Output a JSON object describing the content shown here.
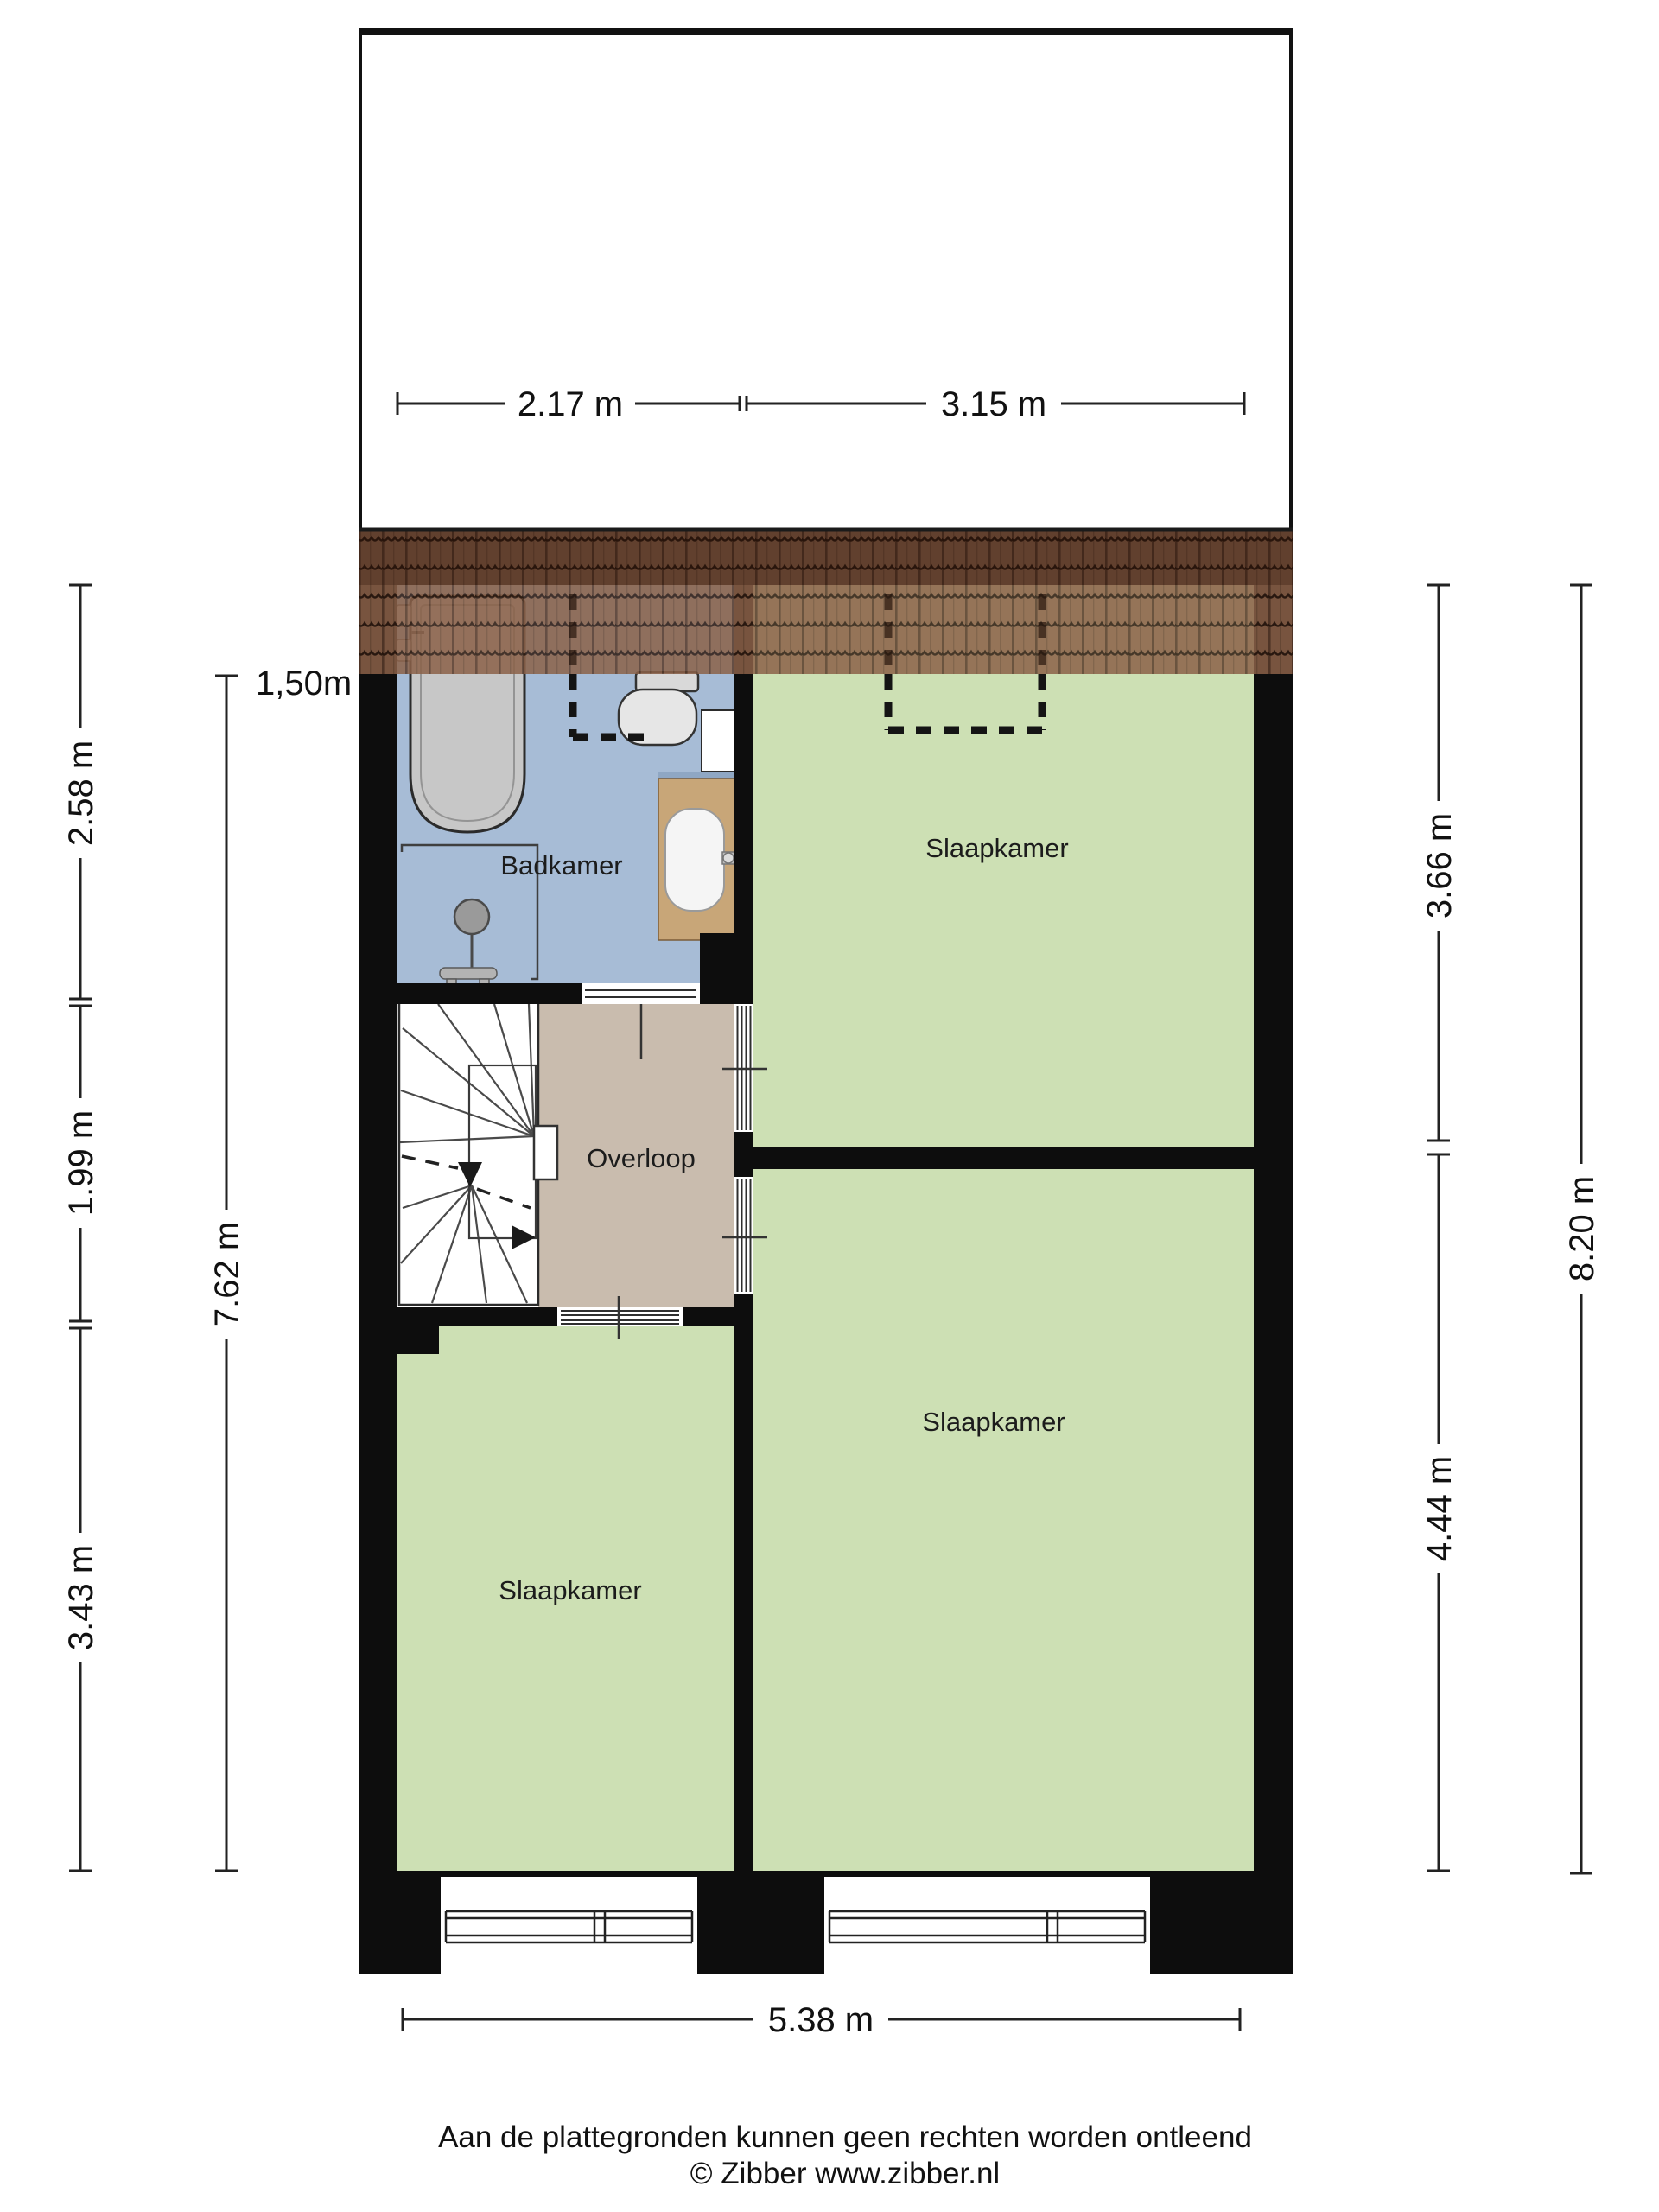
{
  "colors": {
    "wall": "#0d0d0d",
    "bedroom_fill": "#cde0b4",
    "bathroom_fill": "#a7bcd6",
    "landing_fill": "#c9bcae",
    "roof_base": "#8b6148",
    "stair_area_fill": "#ffffff",
    "fixture_gray": "#c7c7c7",
    "vanity_wood": "#c8a678"
  },
  "rooms": {
    "bathroom": {
      "label": "Badkamer"
    },
    "bedroom_top_right": {
      "label": "Slaapkamer"
    },
    "landing": {
      "label": "Overloop"
    },
    "bedroom_bottom_left": {
      "label": "Slaapkamer"
    },
    "bedroom_bottom_right": {
      "label": "Slaapkamer"
    }
  },
  "dimensions": {
    "top_segment_left": "2.17 m",
    "top_segment_right": "3.15 m",
    "left_bathroom_depth": "2.58 m",
    "left_landing_depth": "1.99 m",
    "left_bedroom_depth": "3.43 m",
    "left_total_depth": "7.62 m",
    "headroom_marker": "1,50m",
    "right_bedroom_top_depth": "3.66 m",
    "right_bedroom_bottom_depth": "4.44 m",
    "right_total_depth": "8.20 m",
    "bottom_total_width": "5.38 m"
  },
  "footer": {
    "disclaimer": "Aan de plattegronden kunnen geen rechten worden ontleend",
    "credit": "© Zibber www.zibber.nl"
  }
}
